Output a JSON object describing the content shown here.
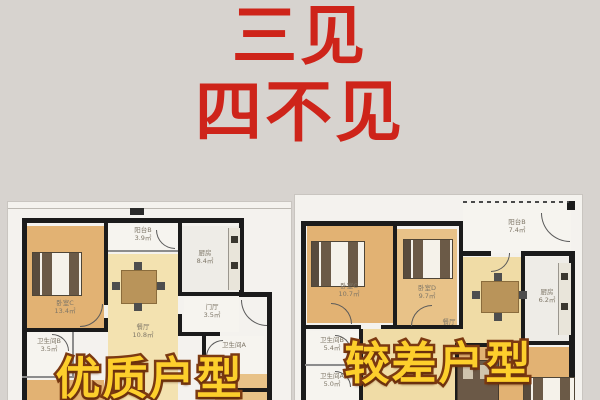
{
  "title": {
    "line1": "三见",
    "line2": "四不见"
  },
  "plans": {
    "good": {
      "caption": "优质户型",
      "rooms": {
        "bedroomC": {
          "name": "卧室C",
          "area": "13.4㎡"
        },
        "balconyB": {
          "name": "阳台B",
          "area": "3.9㎡"
        },
        "kitchen": {
          "name": "厨房",
          "area": "8.4㎡"
        },
        "dining": {
          "name": "餐厅",
          "area": "10.8㎡"
        },
        "hall": {
          "name": "门厅",
          "area": "3.5㎡"
        },
        "bathB": {
          "name": "卫生间B",
          "area": "3.5㎡"
        },
        "bathA": {
          "name": "卫生间A",
          "area": ""
        }
      }
    },
    "bad": {
      "caption": "较差户型",
      "rooms": {
        "bedroomC": {
          "name": "卧室C",
          "area": "10.7㎡"
        },
        "bedroomD": {
          "name": "卧室D",
          "area": "9.7㎡"
        },
        "balconyB": {
          "name": "阳台B",
          "area": "7.4㎡"
        },
        "kitchen": {
          "name": "厨房",
          "area": "6.2㎡"
        },
        "dining": {
          "name": "餐厅",
          "area": ""
        },
        "bathB": {
          "name": "卫生间B",
          "area": "5.4㎡"
        },
        "bathA": {
          "name": "卫生间A",
          "area": "5.0㎡"
        },
        "bedroomA": {
          "name": "卧室A",
          "area": "13.0㎡"
        }
      }
    }
  },
  "colors": {
    "background": "#d7d3cf",
    "title_red": "#ce241a",
    "caption_yellow": "#fdcf2c",
    "caption_outline": "#7c3a12",
    "wall_black": "#1b1b1b",
    "room_tan": "#e2b273",
    "dining_tan": "#f3e2b0",
    "plan_background": "#f4f2ee"
  }
}
